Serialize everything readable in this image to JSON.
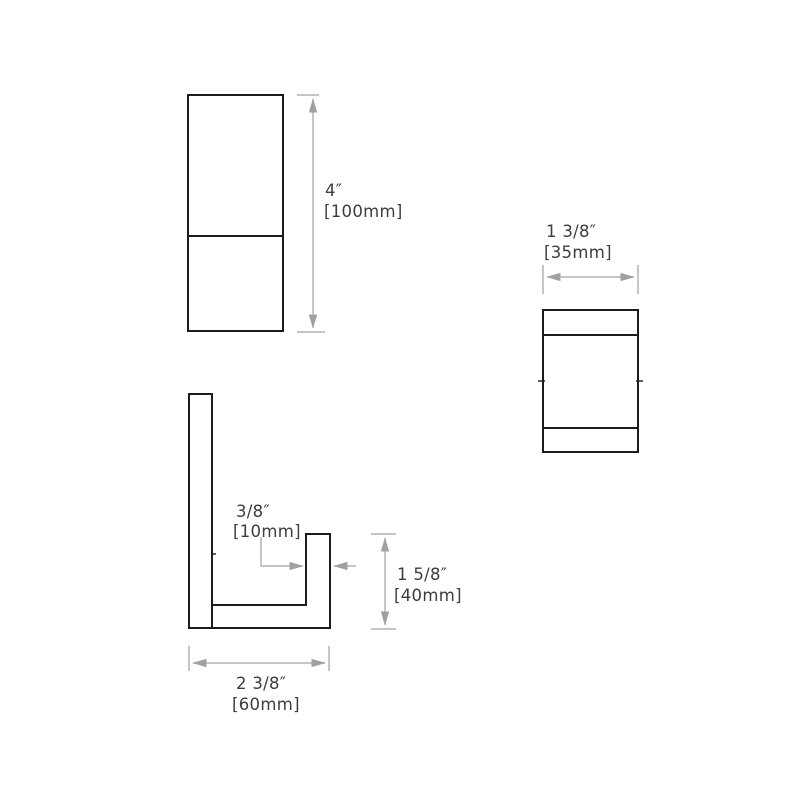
{
  "colors": {
    "background": "#ffffff",
    "outline": "#1c1c1c",
    "dimension_line": "#a0a0a0",
    "label_text": "#3d3d3d"
  },
  "labels": {
    "height": {
      "inches": "4″",
      "mm": "[100mm]"
    },
    "width": {
      "inches": "1 3/8″",
      "mm": "[35mm]"
    },
    "lip_thickness": {
      "inches": "3/8″",
      "mm": "[10mm]"
    },
    "lip_height": {
      "inches": "1 5/8″",
      "mm": "[40mm]"
    },
    "depth": {
      "inches": "2 3/8″",
      "mm": "[60mm]"
    }
  }
}
